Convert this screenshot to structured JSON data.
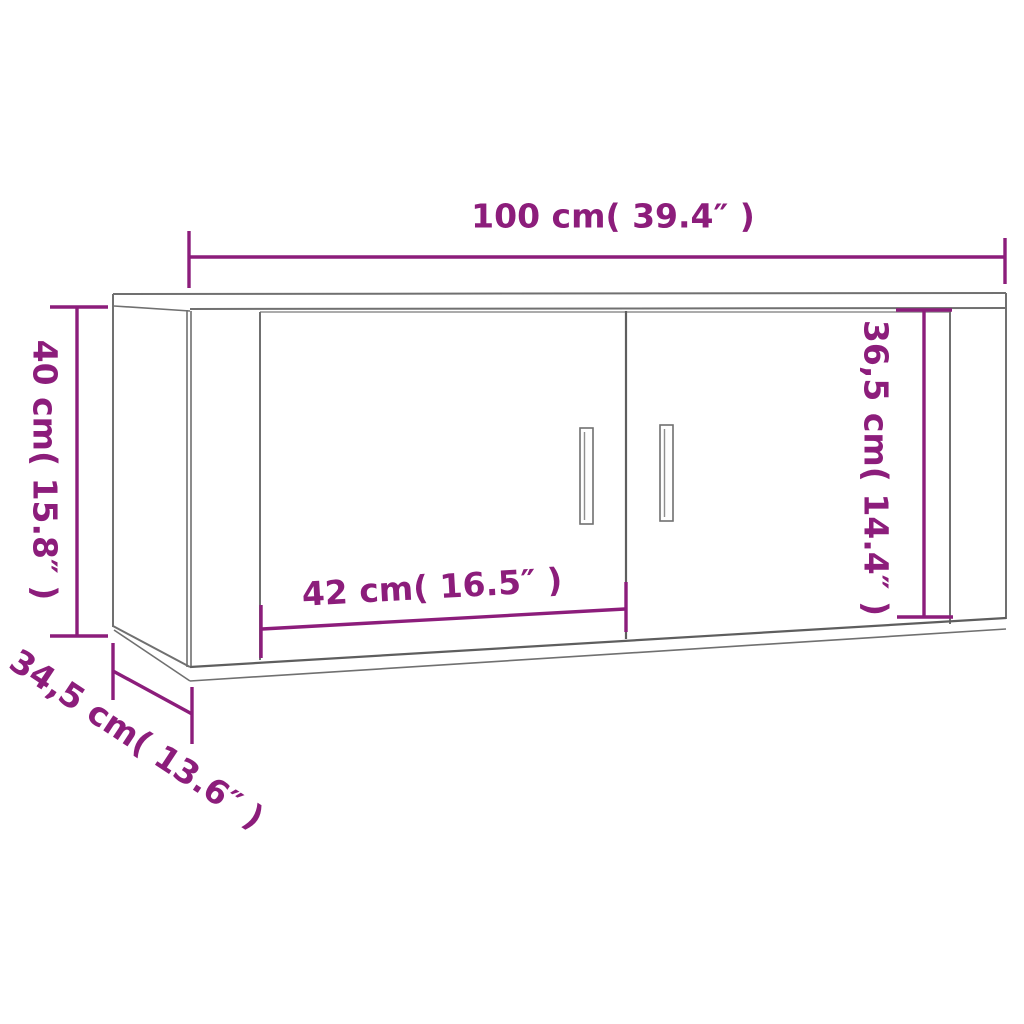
{
  "diagram": {
    "name": "wall-cabinet-dimension-diagram",
    "colors": {
      "dimension_accent": "#8C1D7B",
      "outline_gray": "#707070",
      "background": "#FFFFFF"
    },
    "labels": {
      "width": "100 cm( 39.4″ )",
      "height": "40 cm( 15.8″ )",
      "door_width": "42 cm( 16.5″ )",
      "inner_height": "36,5 cm( 14.4″ )",
      "depth": "34,5 cm( 13.6″ )"
    },
    "values": {
      "width_cm": "100",
      "width_in": "39.4",
      "height_cm": "40",
      "height_in": "15.8",
      "door_width_cm": "42",
      "door_width_in": "16.5",
      "inner_height_cm": "36,5",
      "inner_height_in": "14.4",
      "depth_cm": "34,5",
      "depth_in": "13.6"
    }
  }
}
